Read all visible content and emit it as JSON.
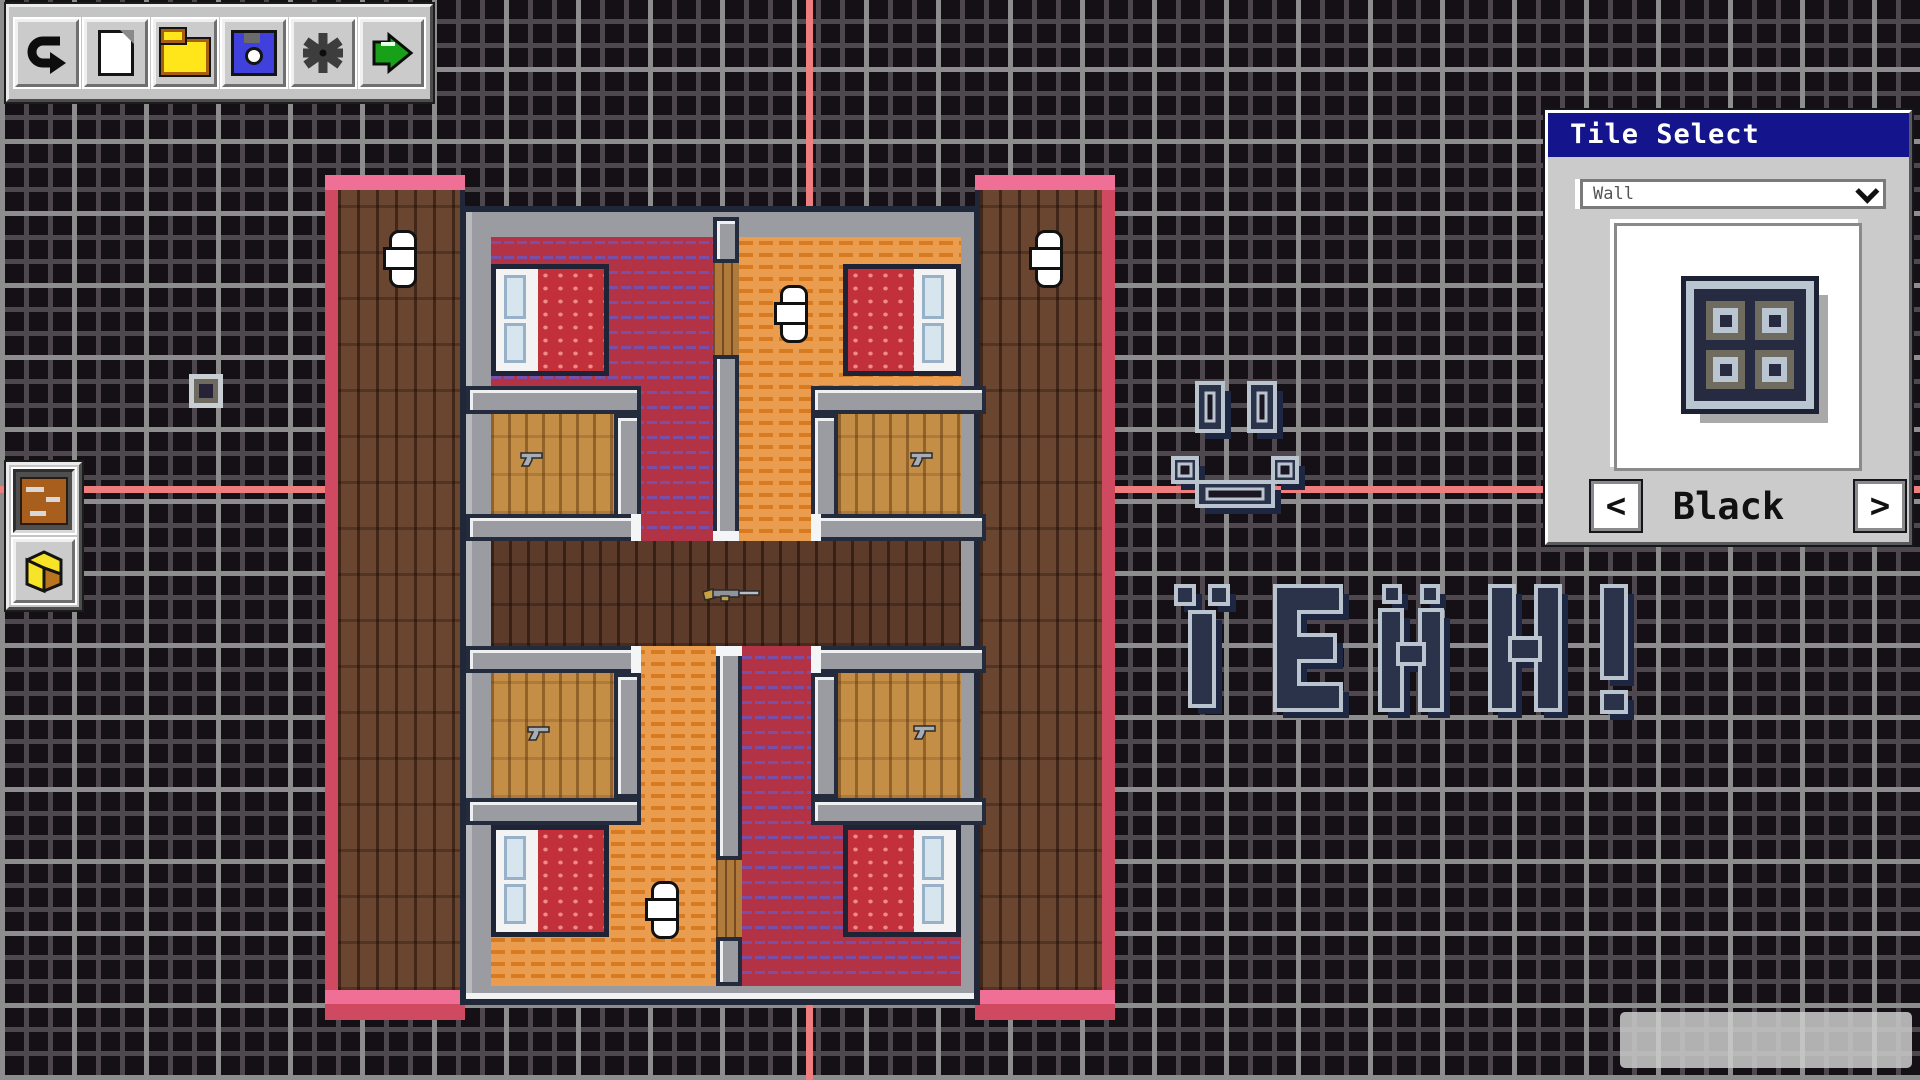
{
  "app": {
    "title": "Tile Map Editor"
  },
  "toolbar": {
    "buttons": [
      {
        "id": "undo",
        "icon": "undo-arrow-icon"
      },
      {
        "id": "new-file",
        "icon": "new-file-icon"
      },
      {
        "id": "open-file",
        "icon": "folder-icon"
      },
      {
        "id": "save",
        "icon": "floppy-disk-icon"
      },
      {
        "id": "settings",
        "icon": "gear-icon"
      },
      {
        "id": "run",
        "icon": "play-icon"
      }
    ]
  },
  "tool_panel": {
    "tools": [
      {
        "id": "floor-tile-tool",
        "icon": "wood-tile-icon",
        "selected": true
      },
      {
        "id": "block-tool",
        "icon": "yellow-block-icon",
        "selected": false
      }
    ]
  },
  "tile_select": {
    "title": "Tile Select",
    "category": "Wall",
    "tile_name": "Black",
    "prev_arrow": "<",
    "next_arrow": ">"
  },
  "canvas": {
    "tile_art_text": "YEAH!",
    "smiley": "smiley face drawn with wall tiles",
    "building": {
      "bedrooms": 4,
      "beds": 4,
      "closets_with_pistols": 4,
      "rifles_in_hallway": 1,
      "pillars": 4,
      "wooden_doors": 2
    },
    "colors": {
      "background": "#151015",
      "grid_minor": "#4e484e",
      "grid_major": "#8d8d8d",
      "axis": "#ee7d7d",
      "carpet_red": "#b23345",
      "carpet_zigzag": "#7a4fa8",
      "floor_orange": "#eb9d4f",
      "wood_light": "#c48e46",
      "wood_dark": "#5c3b2a",
      "porch_wood": "#6a452f",
      "wall_gray": "#9b9ca1",
      "trim_pink": "#ef6f97",
      "trim_red": "#cf4961",
      "tile_navy": "#262b42",
      "tile_silver": "#b9c5d1",
      "title_bar_blue": "#14148c"
    }
  },
  "status_box": {
    "text": ""
  }
}
